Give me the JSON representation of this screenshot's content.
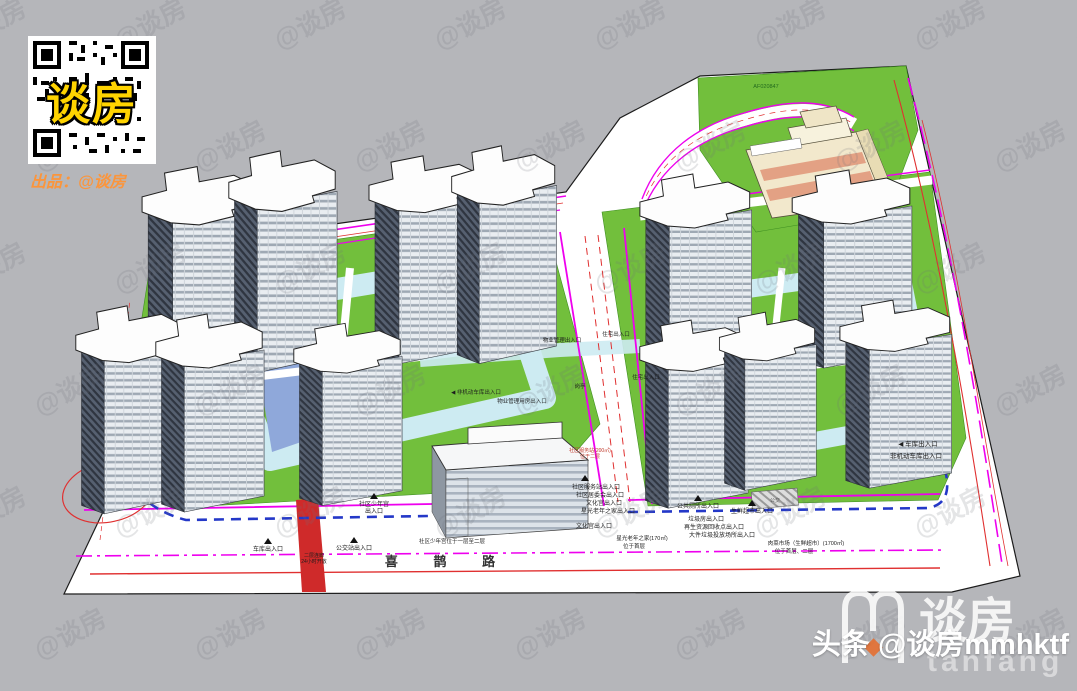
{
  "branding": {
    "qr_overlay": "谈房",
    "producer_line": "出品：@谈房",
    "watermark": "@谈房",
    "footer_handle": "头条 @谈房mmhktf",
    "logo_text": "谈房",
    "logo_sub": "tanfang"
  },
  "colors": {
    "background": "#b5b6ba",
    "paper": "#ffffff",
    "lawn_green": "#72bf3c",
    "podium_blue": "#cdebf2",
    "water_blue": "#8fa8da",
    "magenta_line": "#ee00ee",
    "red_line": "#e03030",
    "red_lane": "#cf2a2a",
    "boundary_blue": "#2438c8",
    "school_beige": "#f2e8cc",
    "school_stripe": "#e3a184",
    "qr_yellow": "#ffd400",
    "producer_orange": "#ff9436",
    "logo_orange": "#e86c2a"
  },
  "plan": {
    "road_name": "喜 鹊 路",
    "parcel_code": "AF020847",
    "labels": [
      "车库出入口",
      "二层连廊",
      "24小时开放",
      "公交站出入口",
      "社区少年宫",
      "出入口",
      "社区少年宫位于一层至二层",
      "社区服务站出入口",
      "社区居委会出入口",
      "文化宫出入口",
      "星光老年之家出入口",
      "社区服务站(200㎡)",
      "位于二层",
      "文化宫出入口",
      "星光老年之家(170㎡)",
      "位于首层",
      "公共厕所出入口",
      "生鲜超市出入口",
      "垃圾房出入口",
      "再生资源回收点出入口",
      "大件垃圾投放场所出入口",
      "肉菜市场（生鲜超市）(1700㎡)",
      "位于首层、二层",
      "◀ 车库出入口",
      "非机动车库出入口",
      "住宅出入口",
      "物业管理出入口",
      "住宅出入口",
      "岗亭",
      "◀ 非机动车库出入口",
      "物业管理用房出入口",
      "公交"
    ]
  }
}
